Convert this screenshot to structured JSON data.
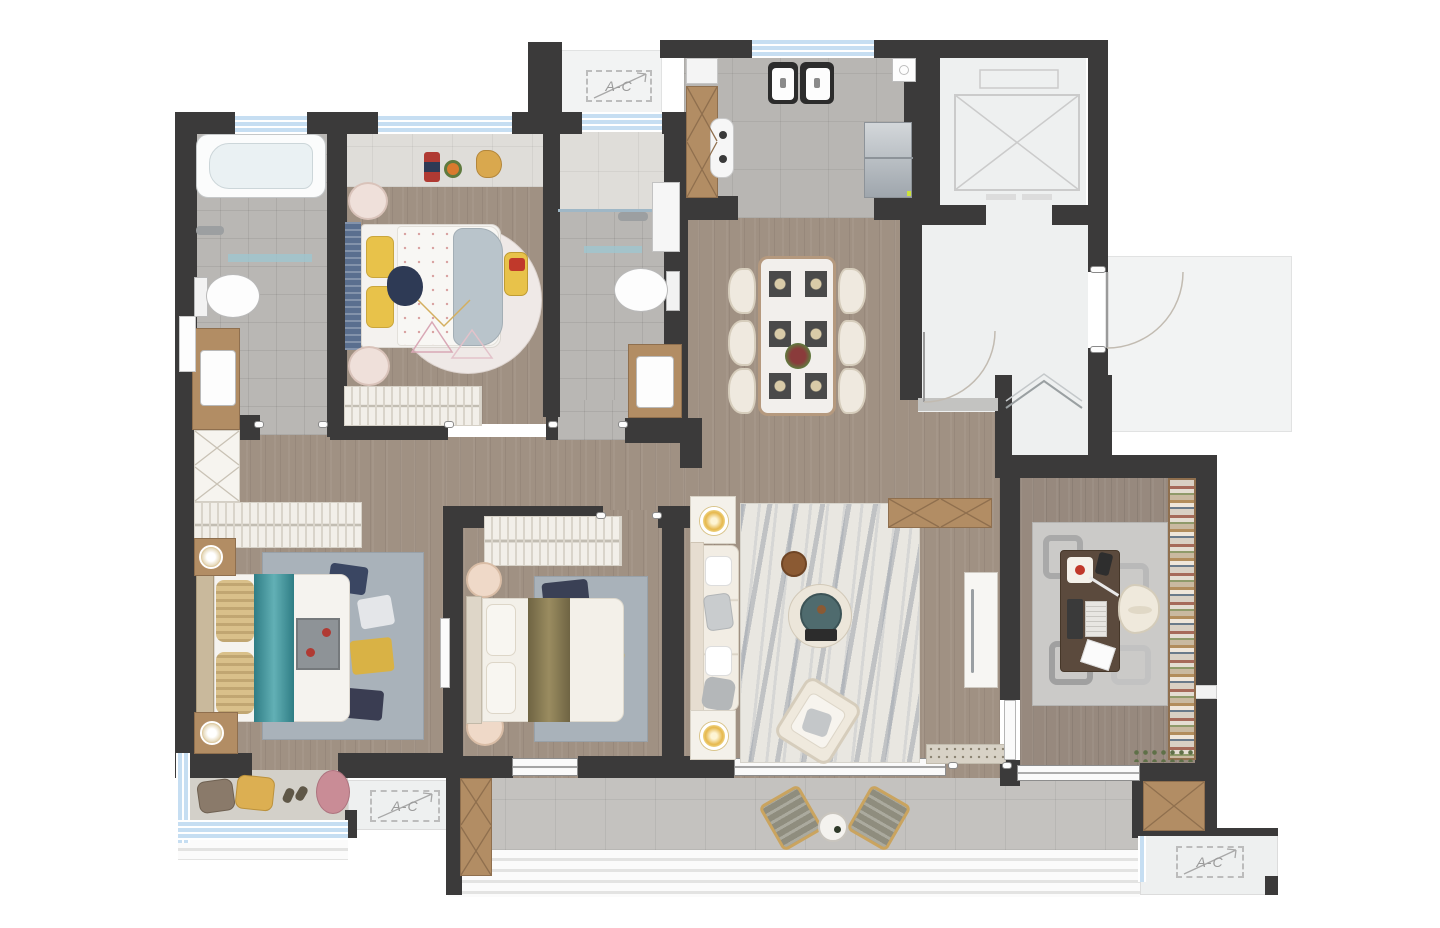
{
  "labels": {
    "ac_unit": "A-C"
  },
  "plan": {
    "title": "Apartment floor plan, top-down render",
    "rooms": [
      {
        "id": "master-bathroom",
        "furniture": [
          "bathtub",
          "toilet",
          "vanity-sink",
          "bath-mat"
        ]
      },
      {
        "id": "kids-bedroom",
        "furniture": [
          "single-bed",
          "round-rug",
          "toy-car",
          "bedside-tables",
          "wardrobe",
          "bay-window-toys"
        ]
      },
      {
        "id": "guest-bathroom",
        "furniture": [
          "walk-in-shower",
          "tall-cabinet",
          "toilet",
          "vanity-sink"
        ]
      },
      {
        "id": "kitchen",
        "furniture": [
          "double-sink",
          "cooktop",
          "l-shaped-counter",
          "refrigerator"
        ]
      },
      {
        "id": "elevator-shaft",
        "furniture": [
          "elevator-car"
        ]
      },
      {
        "id": "entry-foyer",
        "furniture": [
          "entry-door",
          "closet-door",
          "folding-door",
          "utility-alcove"
        ]
      },
      {
        "id": "dining-room",
        "furniture": [
          "dining-table",
          "six-chairs",
          "flower-centerpiece"
        ]
      },
      {
        "id": "living-room",
        "furniture": [
          "sofa",
          "lamp-side-tables",
          "round-coffee-table",
          "marble-rug",
          "accent-chair",
          "stool",
          "console-cabinet",
          "tall-white-cabinet",
          "doormat"
        ]
      },
      {
        "id": "hallway",
        "furniture": [
          "built-in-wardrobe",
          "dresser"
        ]
      },
      {
        "id": "master-bedroom",
        "furniture": [
          "double-bed-teal-runner",
          "nightstands-with-lamps",
          "area-rug"
        ]
      },
      {
        "id": "master-balcony",
        "furniture": [
          "floor-cushions",
          "slippers"
        ]
      },
      {
        "id": "bedroom-two",
        "furniture": [
          "double-bed-olive-runner",
          "round-nightstands",
          "wardrobe",
          "area-rug"
        ]
      },
      {
        "id": "study",
        "furniture": [
          "desk",
          "desk-chair",
          "laptop",
          "bookshelf",
          "geometric-rug",
          "plant-strip"
        ]
      },
      {
        "id": "terrace",
        "furniture": [
          "lounge-chair-left",
          "lounge-chair-right",
          "round-side-table"
        ]
      },
      {
        "id": "ac-platform-north",
        "label": "A-C"
      },
      {
        "id": "ac-platform-southwest",
        "label": "A-C"
      },
      {
        "id": "ac-platform-southeast",
        "label": "A-C"
      }
    ],
    "palette": {
      "wall": "#3b3a3a",
      "wood_floor": "#a09183",
      "bath_tile": "#b9b7b4",
      "marble_tile": "#dfddd9",
      "terrace_tile": "#c4c2bf",
      "common_white": "#eef0f0",
      "window_blue": "#c6def2",
      "cabinet_wood": "#b28d64",
      "accent_teal": "#3c8b92",
      "accent_yellow": "#e8c24a",
      "accent_olive": "#8a7d57",
      "accent_gold": "#e6b84d"
    }
  }
}
